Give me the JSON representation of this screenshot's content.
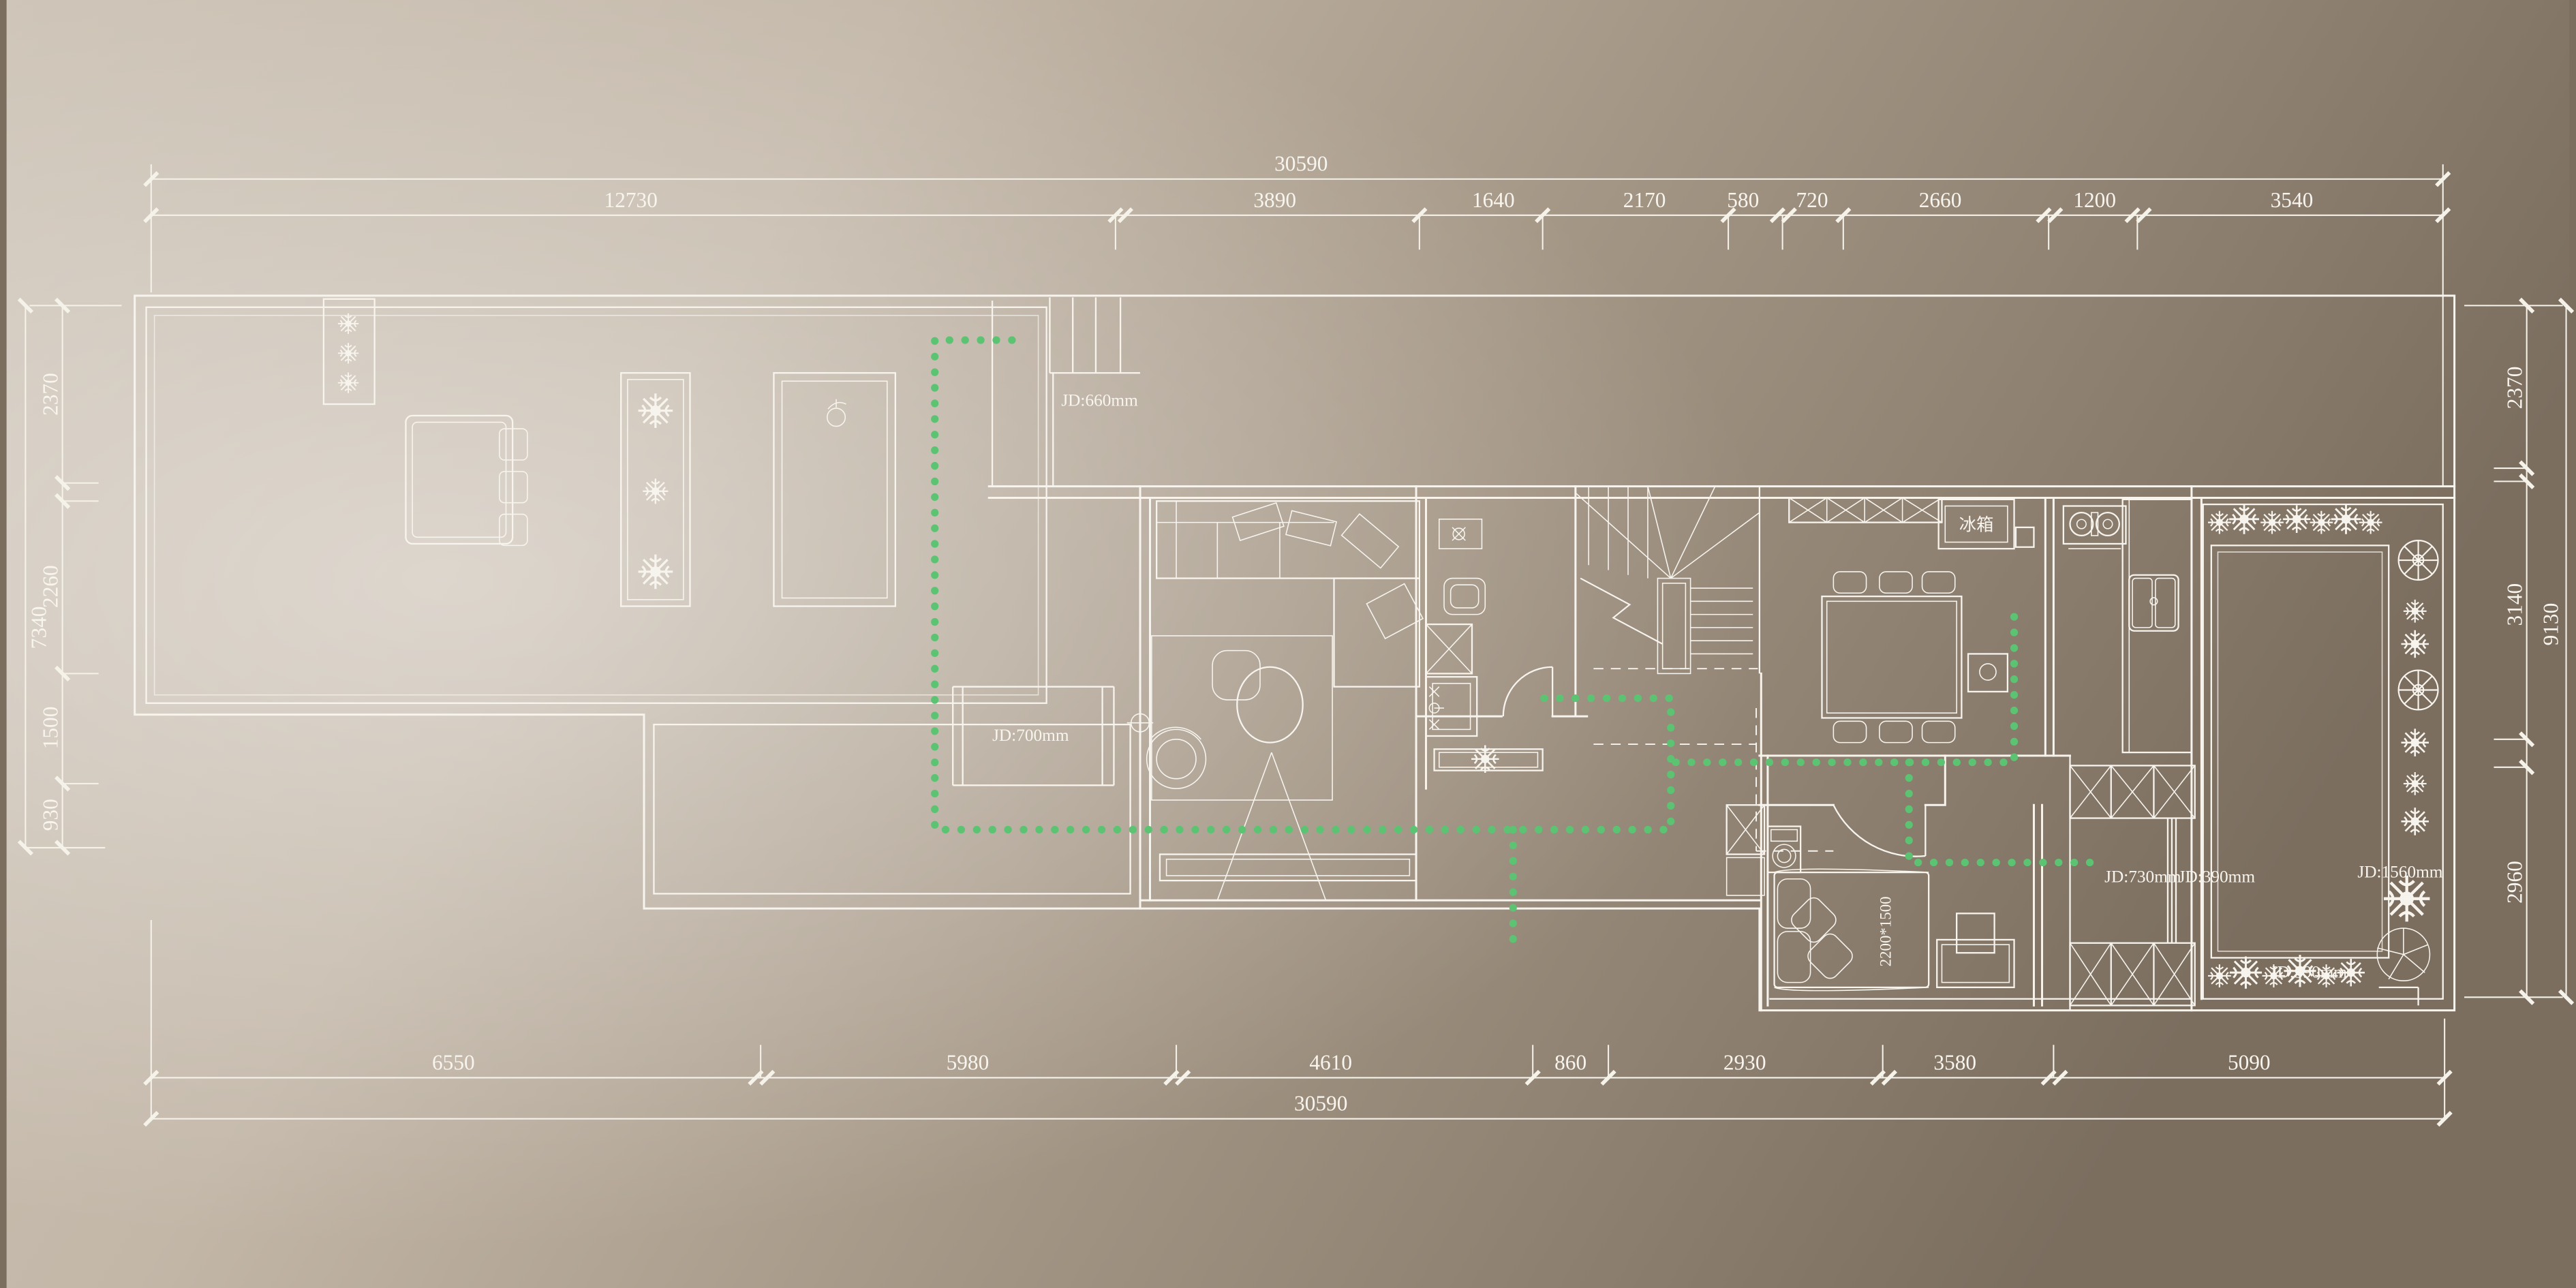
{
  "drawing": {
    "type": "residential floor plan with ceiling/duct annotations",
    "units": "mm"
  },
  "dims": {
    "top": {
      "total": "30590",
      "segments": [
        "12730",
        "3890",
        "1640",
        "2170",
        "580",
        "720",
        "2660",
        "1200",
        "3540"
      ]
    },
    "bottom": {
      "total": "30590",
      "segments": [
        "6550",
        "5980",
        "4610",
        "860",
        "2930",
        "3580",
        "5090"
      ]
    },
    "left": {
      "total": "7340",
      "segments": [
        "2370",
        "2260",
        "1500",
        "930"
      ]
    },
    "right": {
      "total": "9130",
      "segments": [
        "2370",
        "3140",
        "2960"
      ]
    }
  },
  "labels": {
    "jd660": "JD:660mm",
    "jd700": "JD:700mm",
    "jd730": "JD:730mm",
    "jd390": "JD:390mm",
    "jd1560": "JD:1560mm",
    "jd390b": "JD:390mm",
    "fridge": "冰箱",
    "bed_size": "2200*1500"
  },
  "colors": {
    "line": "#f7f4ee",
    "green_dots": "#5cc373",
    "bg_light": "#d8cfc2",
    "bg_dark": "#7b6e5f"
  }
}
